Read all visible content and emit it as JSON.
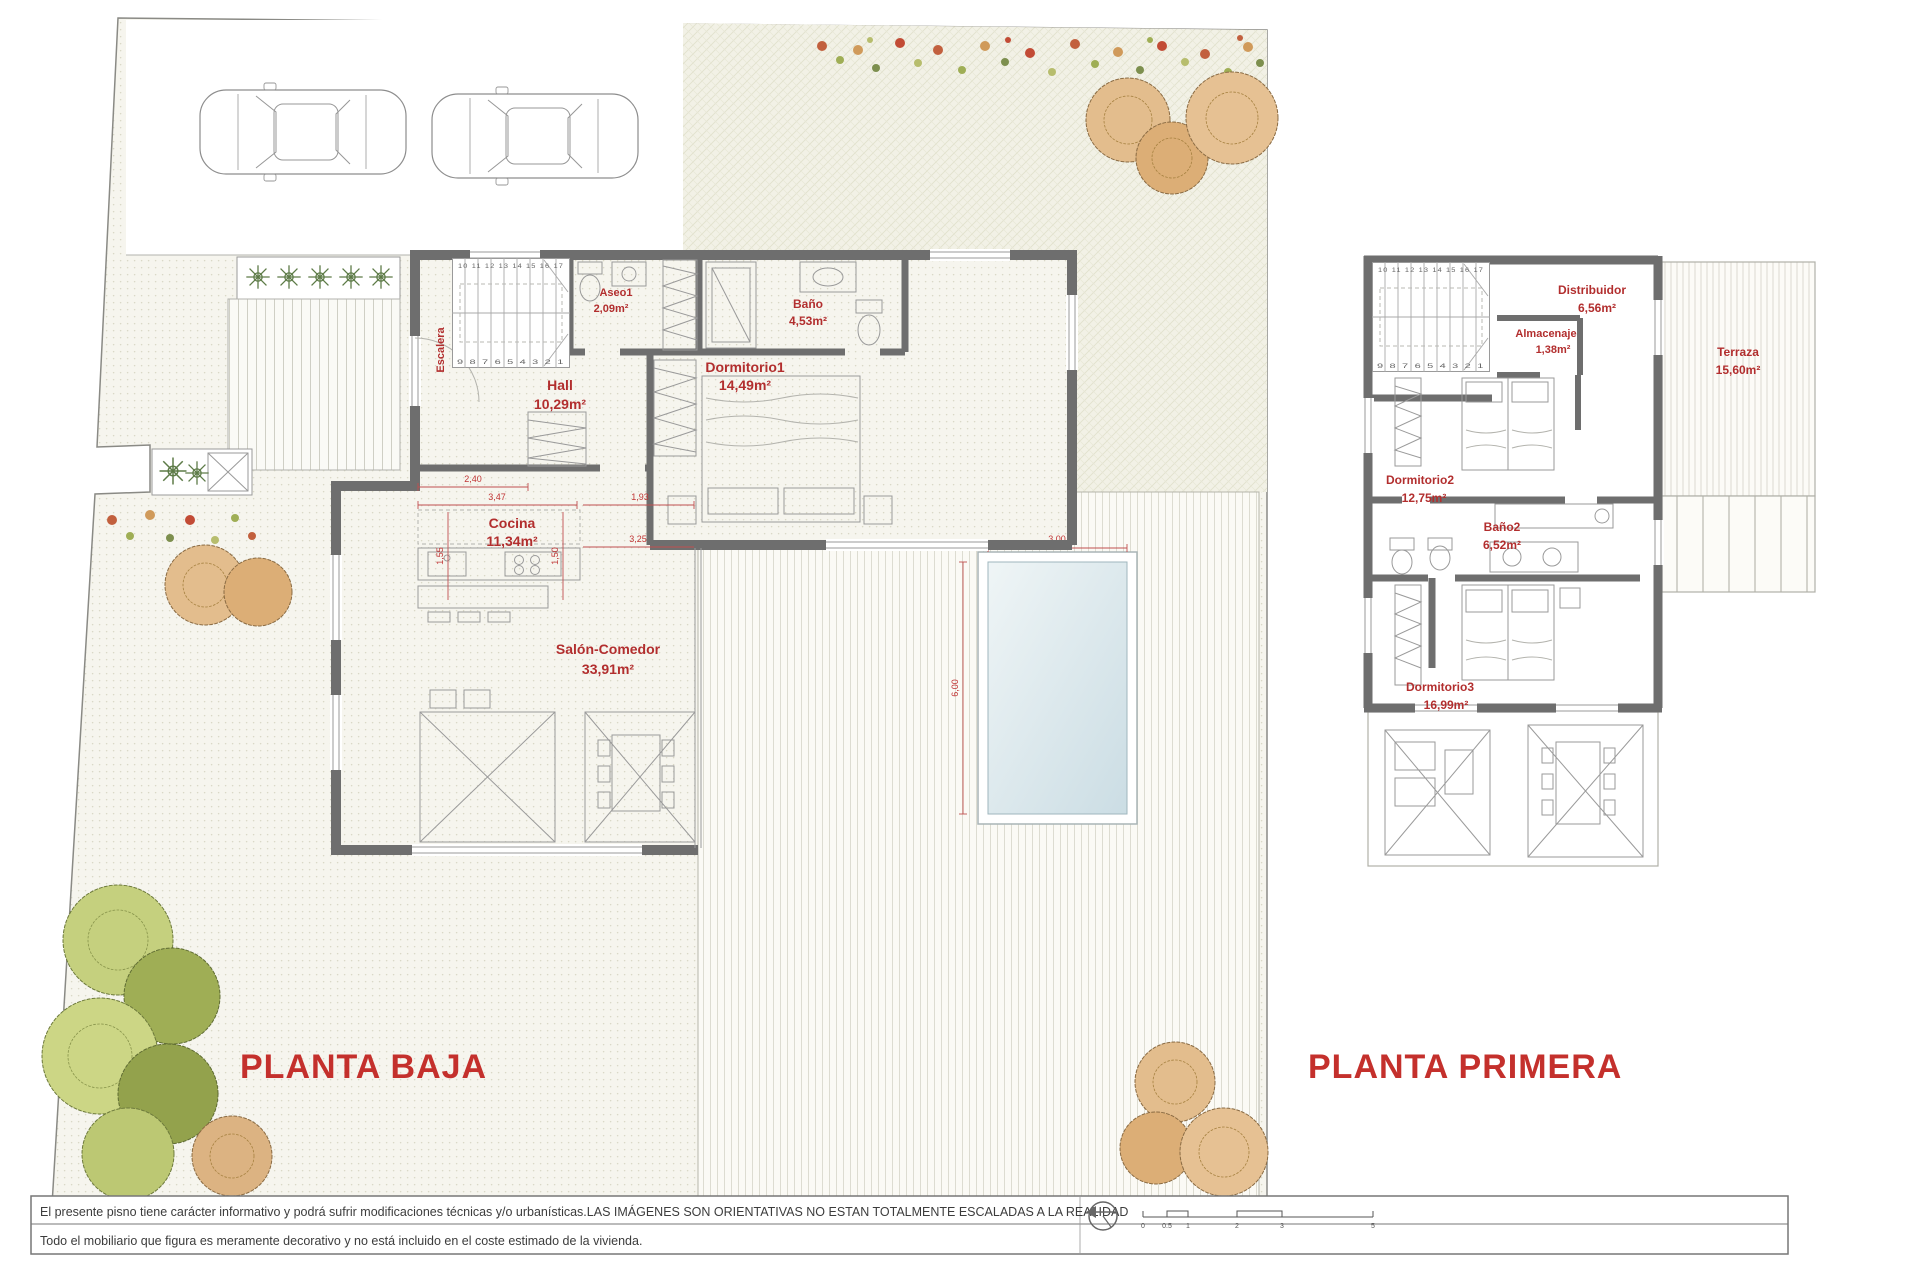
{
  "plans": {
    "baja": {
      "title": "PLANTA BAJA",
      "rooms": {
        "escalera": {
          "label": "Escalera"
        },
        "aseo": {
          "label": "Aseo1",
          "area": "2,09m²"
        },
        "bano": {
          "label": "Baño",
          "area": "4,53m²"
        },
        "dormitorio1": {
          "label": "Dormitorio1",
          "area": "14,49m²"
        },
        "hall": {
          "label": "Hall",
          "area": "10,29m²"
        },
        "cocina": {
          "label": "Cocina",
          "area": "11,34m²"
        },
        "salon": {
          "label": "Salón-Comedor",
          "area": "33,91m²"
        }
      },
      "dims": {
        "w1": "2,40",
        "w2": "3,47",
        "w3": "1,93",
        "h1": "1,55",
        "h2": "1,50",
        "w4": "3,25",
        "pool_w": "3,00",
        "pool_h": "6,00"
      }
    },
    "primera": {
      "title": "PLANTA PRIMERA",
      "rooms": {
        "distribuidor": {
          "label": "Distribuidor",
          "area": "6,56m²"
        },
        "almacenaje": {
          "label": "Almacenaje",
          "area": "1,38m²"
        },
        "terraza": {
          "label": "Terraza",
          "area": "15,60m²"
        },
        "dormitorio2": {
          "label": "Dormitorio2",
          "area": "12,75m²"
        },
        "bano2": {
          "label": "Baño2",
          "area": "6,52m²"
        },
        "dormitorio3": {
          "label": "Dormitorio3",
          "area": "16,99m²"
        }
      }
    }
  },
  "stair_numbers": {
    "top": "10 11 12 13 14 15 16 17",
    "bottom": "9 8 7 6 5 4 3 2 1"
  },
  "footer": {
    "line1": "El presente  pisno tiene carácter informativo y podrá  sufrir modificaciones técnicas y/o urbanísticas.LAS IMÁGENES SON ORIENTATIVAS NO ESTAN TOTALMENTE ESCALADAS A LA REALIDAD",
    "line2": "Todo el mobiliario que figura es meramente decorativo y no está incluido en el coste estimado de la vivienda.",
    "scale_ticks": [
      "0",
      "0.5",
      "1",
      "2",
      "3",
      "5"
    ]
  },
  "colors": {
    "label_red": "#b22e2e",
    "title_red": "#c4302c",
    "wall_gray": "#6e6e6e",
    "pool_blue": "#d9e7eb"
  }
}
